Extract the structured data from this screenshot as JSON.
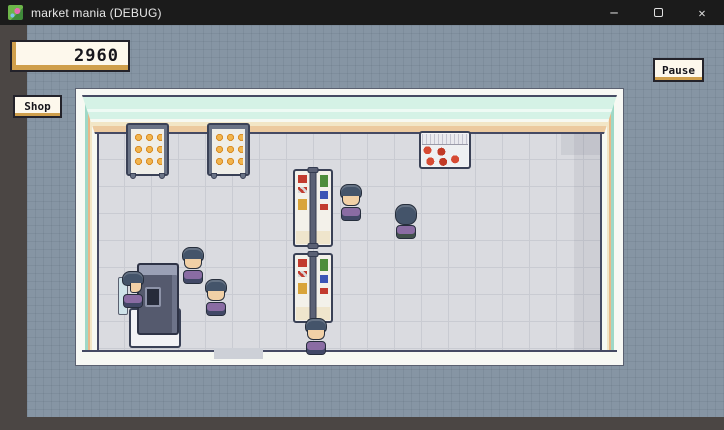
{
  "window": {
    "title": "market mania (DEBUG)",
    "icon": "flower-pixel-app-icon",
    "minimize_glyph": "─",
    "close_glyph": "✕"
  },
  "hud": {
    "money": "2960",
    "shop_label": "Shop",
    "pause_label": "Pause"
  },
  "scene": {
    "description": "top-down pixel-art supermarket interior on graph-paper backdrop",
    "fixtures": [
      {
        "type": "bread-rack",
        "items": "3x3 orange buns"
      },
      {
        "type": "bread-rack",
        "items": "3x3 orange buns"
      },
      {
        "type": "meat-display-case",
        "items": "red meat cuts"
      },
      {
        "type": "gondola-shelf",
        "items": "red, yellow, green, blue packages"
      },
      {
        "type": "gondola-shelf",
        "items": "red, yellow, green, blue packages"
      },
      {
        "type": "checkout-counter",
        "items": "cash register"
      }
    ],
    "npcs": [
      {
        "role": "customer",
        "facing": "down"
      },
      {
        "role": "customer",
        "facing": "up"
      },
      {
        "role": "customer",
        "facing": "down"
      },
      {
        "role": "customer",
        "facing": "down"
      },
      {
        "role": "cashier",
        "facing": "right"
      },
      {
        "role": "customer",
        "facing": "down"
      }
    ],
    "entrance": "gap in bottom wall"
  },
  "colors": {
    "titlebar": "#1b1b1b",
    "canvas_dark": "#4b4644",
    "grid_panel": "#8695a4",
    "panel_cream": "#fdf8ec",
    "panel_gold": "#cf9f4c",
    "wall_mint": "#d5f2e6",
    "wall_peach": "#ecca9f",
    "floor": "#dadbe0",
    "outline_navy": "#454a63",
    "npc_shirt": "#8a6ca3",
    "npc_hair": "#44546a"
  }
}
